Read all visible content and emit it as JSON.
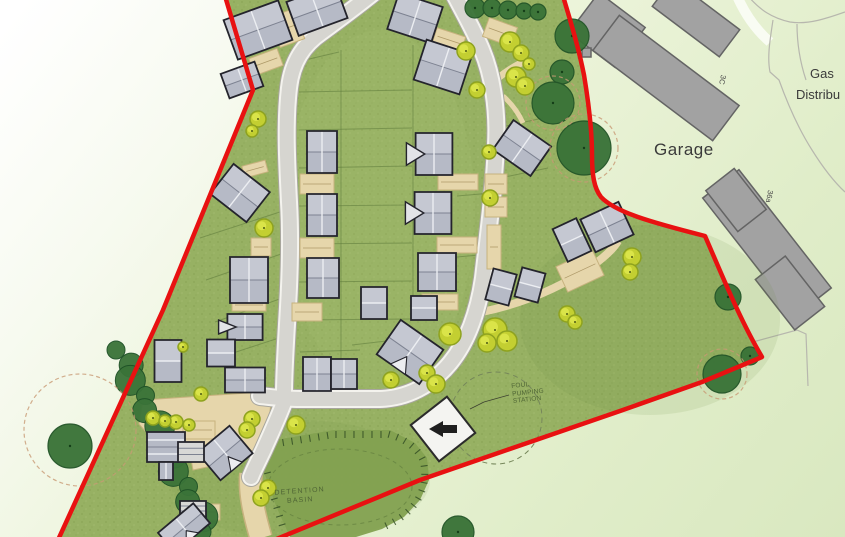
{
  "labels": {
    "garage": "Garage",
    "gas_line1": "Gas",
    "gas_line2": "Distribu",
    "building_3c": "3C",
    "building_36a": "36a"
  },
  "annotations": {
    "pumping": [
      "FOUL",
      "PUMPING",
      "STATION"
    ],
    "basin": [
      "DETENTION",
      "BASIN"
    ]
  },
  "colors": {
    "boundary_red": "#e81111",
    "grass": "#97b163",
    "grass_dark": "#7e9b4e",
    "road_fill": "#d6d5d0",
    "road_kerb": "#f4f3ee",
    "road_casing": "#a8a69e",
    "tan": "#e6d6ab",
    "tan_edge": "#c7b27e",
    "roof": "#b6bac6",
    "roof_light": "#c9ccd6",
    "roof_outline": "#24242c",
    "building_gray": "#a2a2a2",
    "building_outline": "#646464",
    "tree_dark": "#3a7338",
    "tree_yellow": "#c3cf31",
    "basin": "#83a150",
    "label_dark": "#3a3a3a",
    "annotation_green": "#4f6535"
  }
}
